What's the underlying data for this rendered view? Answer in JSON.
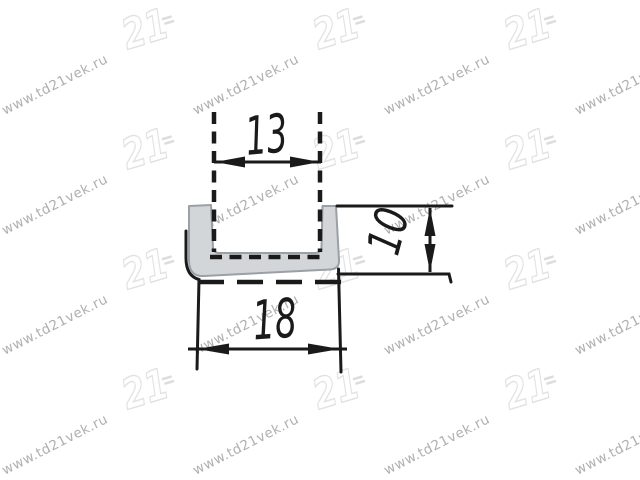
{
  "page": {
    "width": 640,
    "height": 480,
    "background_color": "#ffffff"
  },
  "watermark": {
    "site_text": "www.td21vek.ru",
    "logo_text": "21",
    "text_color": "#b0b0b0",
    "logo_outline_color": "#e2e2e2",
    "logo_accent_color": "#dcdcdc",
    "text_rotation_deg": -27,
    "logo_rotation_deg": -17,
    "text_font_px": 13.5,
    "text_centers_x": [
      55,
      246,
      437,
      628
    ],
    "text_centers_y": [
      85,
      205,
      325,
      445
    ],
    "logo_centers_x": [
      -41,
      150,
      341,
      532
    ],
    "logo_centers_y": [
      30,
      150,
      270,
      390
    ]
  },
  "drawing": {
    "subject": "U-channel profile cross-section",
    "line_color": "#1a1a1a",
    "profile_fill_color": "#d3d6d9",
    "profile_stroke_color": "#9aa0a6",
    "dimensions": {
      "inner_width": {
        "label": "13",
        "value": 13
      },
      "outer_width": {
        "label": "18",
        "value": 18
      },
      "height": {
        "label": "10",
        "value": 10
      }
    }
  }
}
